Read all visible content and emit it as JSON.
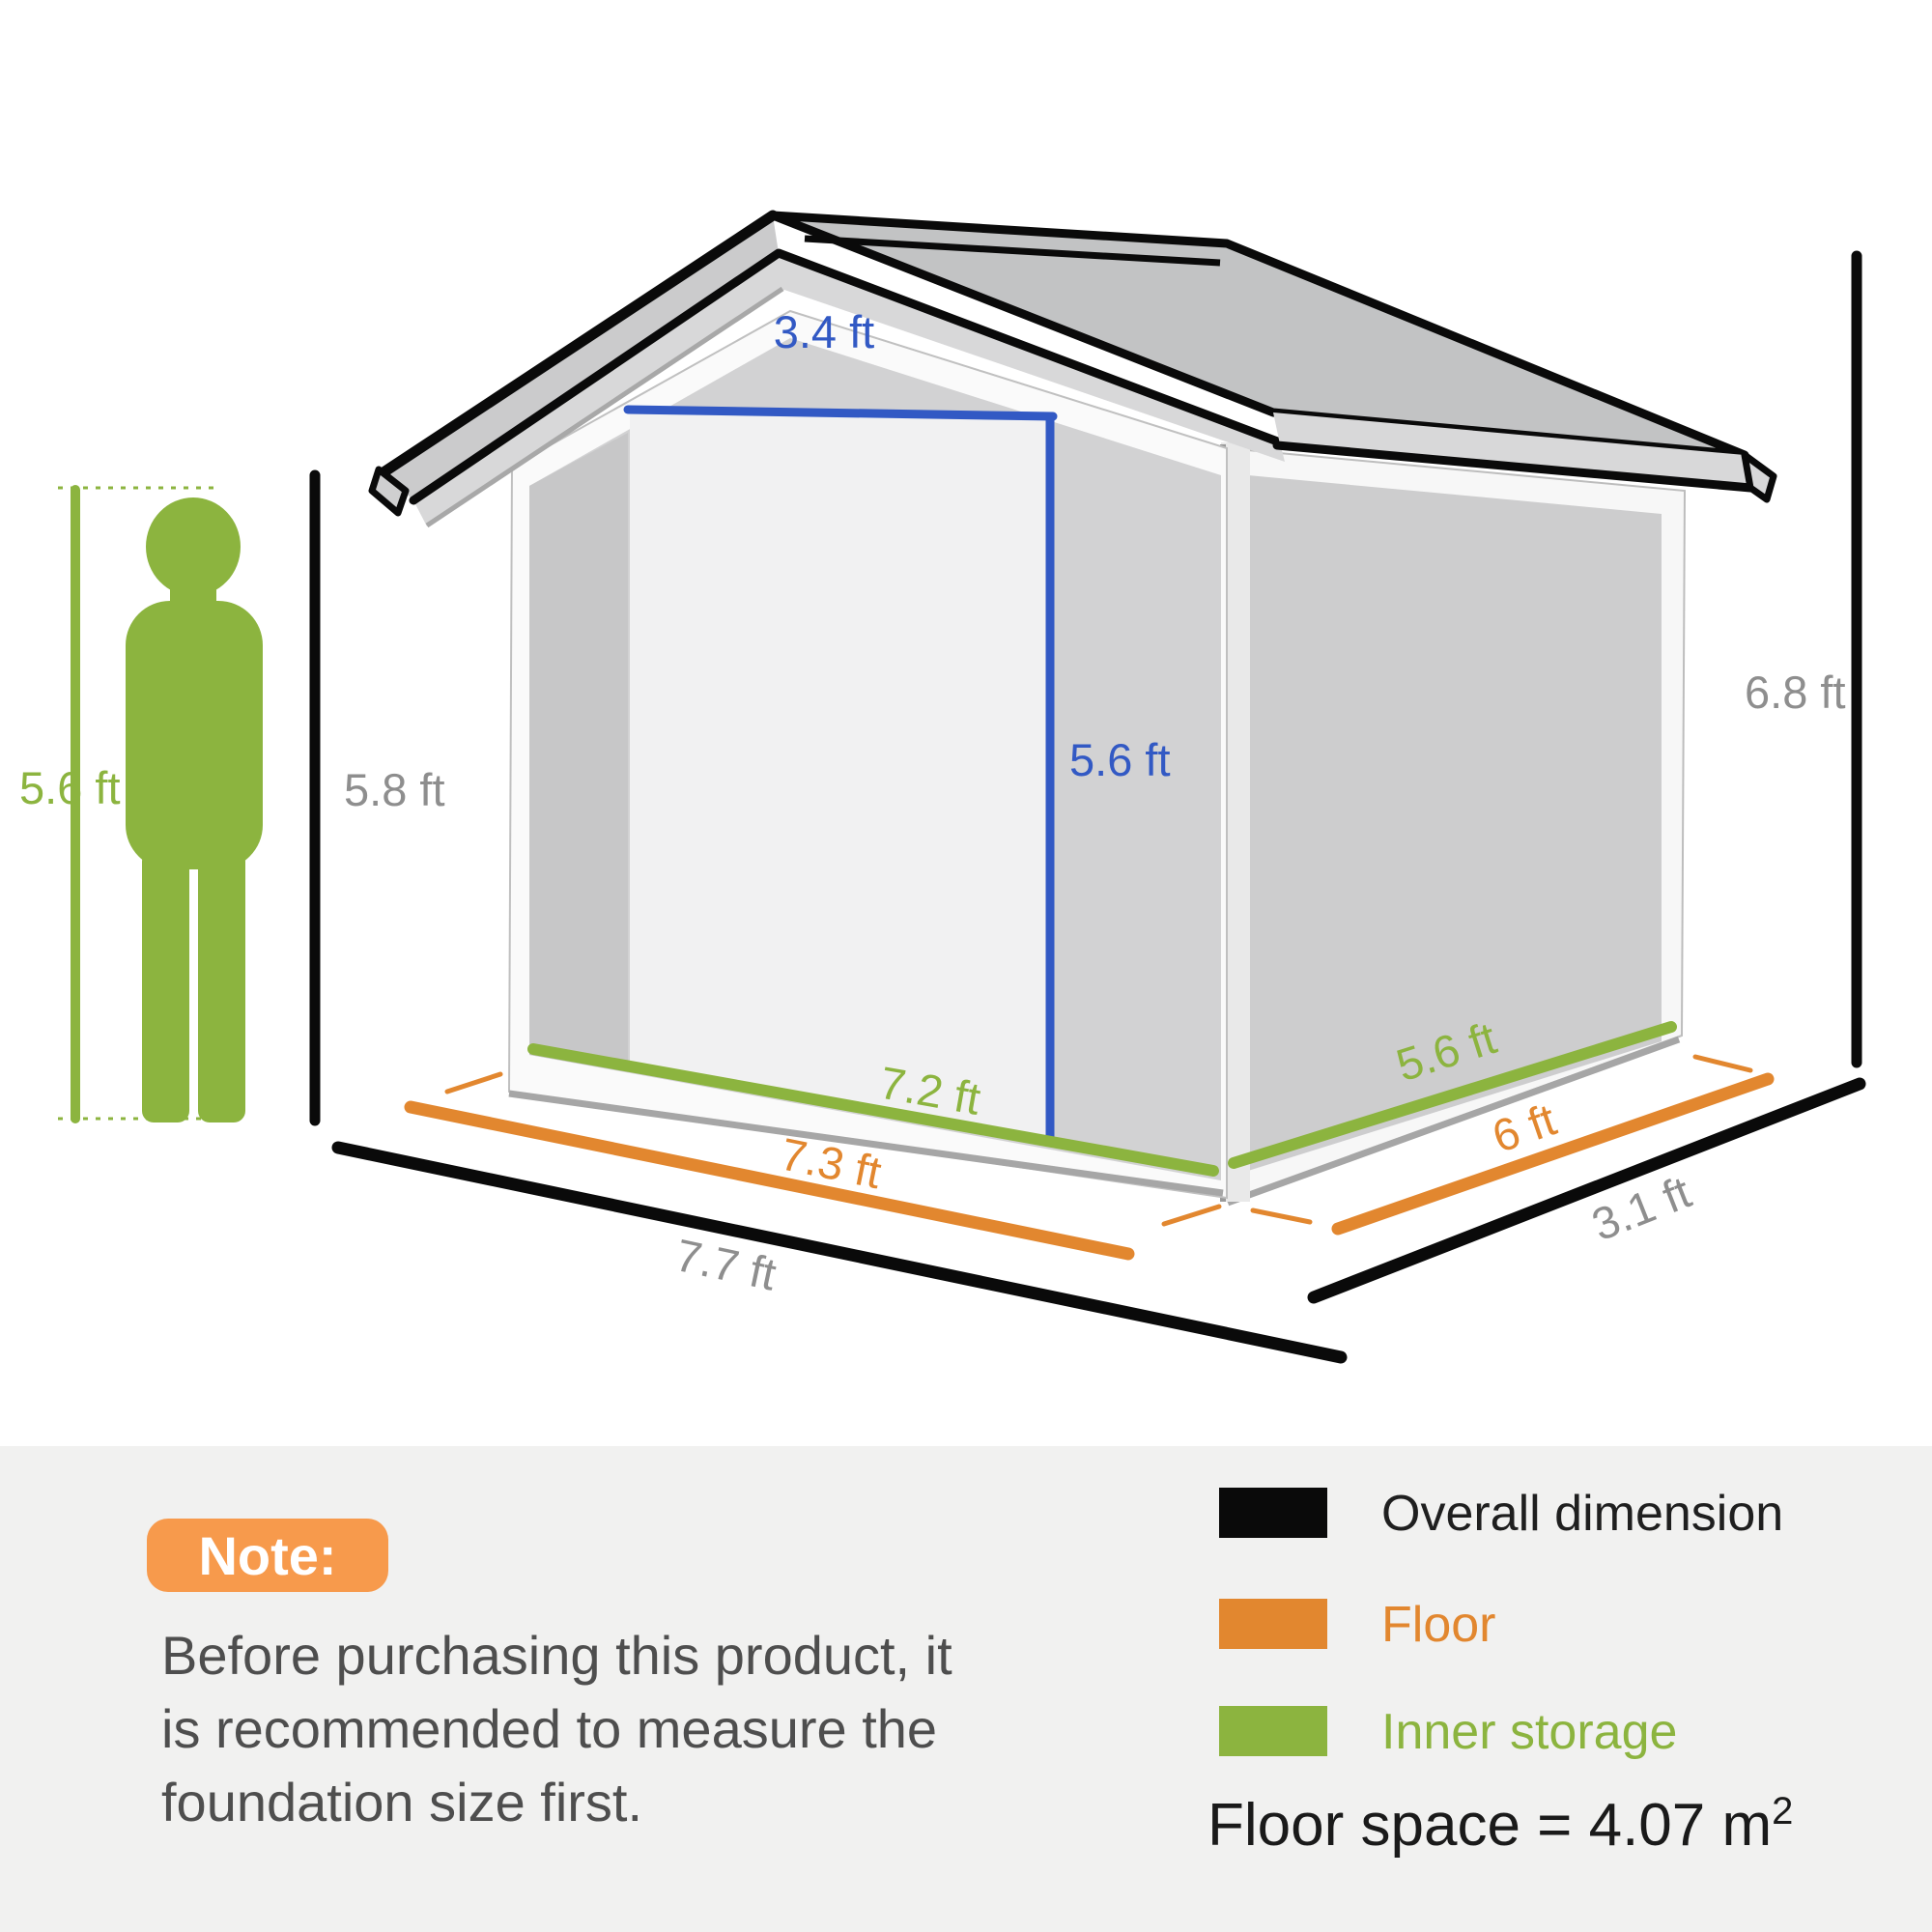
{
  "labels": {
    "person_height": "5.6 ft",
    "wall_height": "5.8 ft",
    "overall_height": "6.8 ft",
    "door_width": "3.4 ft",
    "door_height": "5.6 ft",
    "inner_width": "7.2 ft",
    "floor_width": "7.3 ft",
    "overall_width": "7.7 ft",
    "inner_depth": "5.6 ft",
    "floor_depth": "6 ft",
    "overall_depth": "3.1 ft"
  },
  "note": {
    "badge": "Note:",
    "lines": [
      "Before purchasing this product, it",
      "is recommended to measure the",
      "foundation size first."
    ]
  },
  "legend": {
    "overall": "Overall dimension",
    "floor": "Floor",
    "inner": "Inner storage",
    "floor_space": "Floor space = 4.07 m",
    "floor_space_exp": "2"
  },
  "colors": {
    "green": "#8CB43F",
    "orange": "#E2872F",
    "badge_orange": "#F79A4C",
    "blue": "#3259C4",
    "black": "#0A0A0A",
    "gray_label": "#8E8E8E"
  }
}
